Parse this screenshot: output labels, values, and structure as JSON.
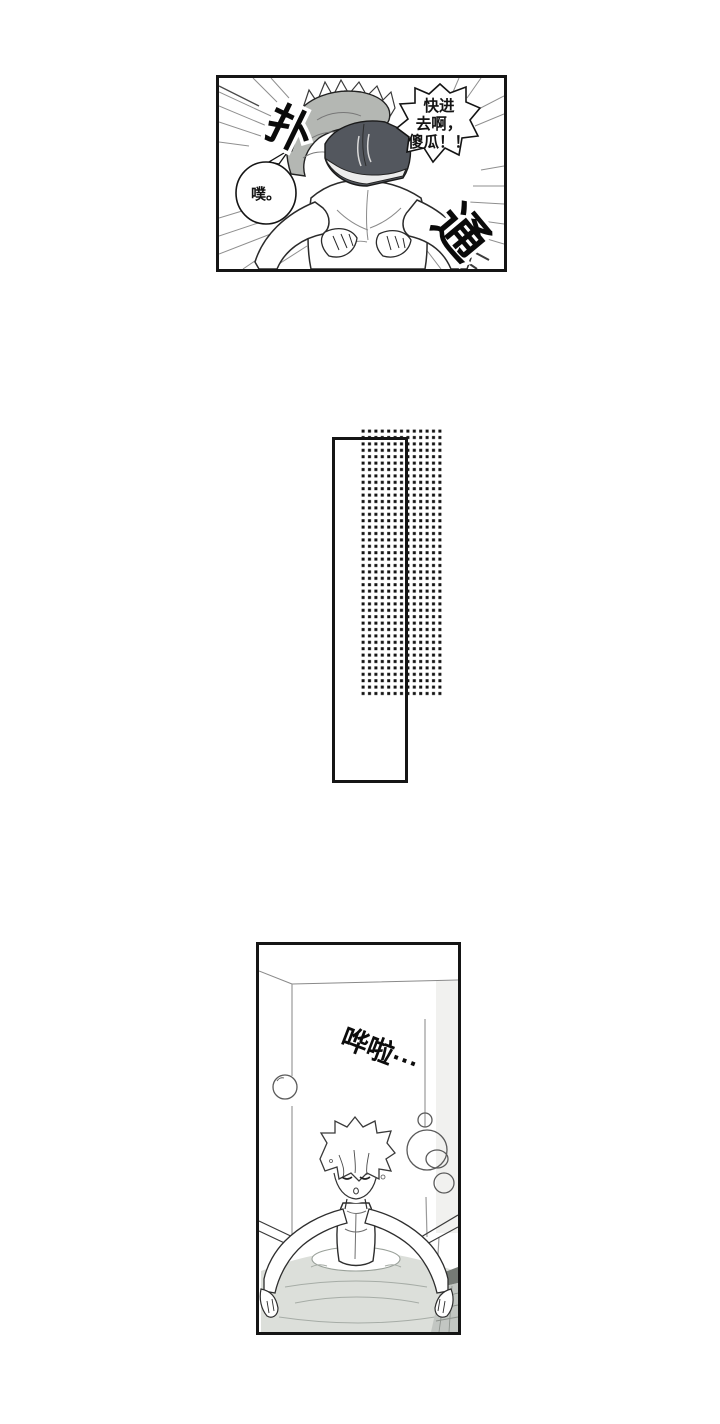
{
  "page": {
    "background": "#ffffff"
  },
  "panel_top": {
    "shout_bubble_lines": [
      "快进",
      "去啊，",
      "傻瓜！！"
    ],
    "small_bubble_text": "噗。",
    "sfx_plop": "扑",
    "sfx_thud": "通"
  },
  "panel_bottom": {
    "sfx_splash": "哗啦···"
  },
  "colors": {
    "ink": "#141414",
    "panel_border": "#151515",
    "line_gray": "#8f8f8f",
    "shirt_gray": "#b4b7b3",
    "shorts_dark": "#53575e",
    "water_gray": "#dcdfda",
    "ripple_gray": "#a6aca6",
    "tile_light": "#c2c6c2",
    "tile_dark": "#757a75",
    "halftone_dot": "#141414"
  }
}
